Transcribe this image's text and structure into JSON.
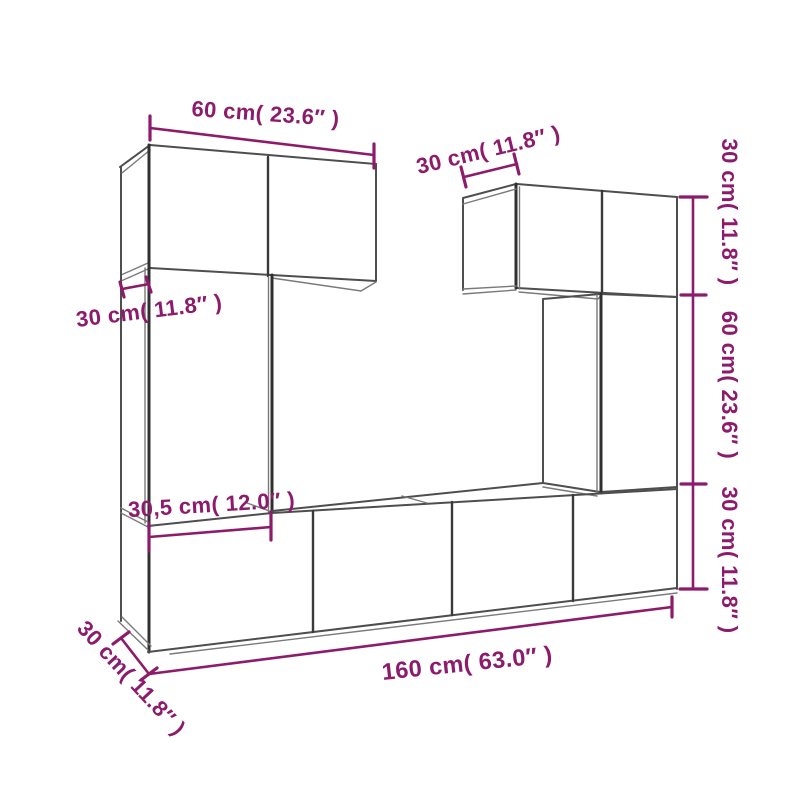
{
  "diagram": {
    "background": "#ffffff",
    "outline_color": "#4E4E4E",
    "accent_color": "#8C1B6C",
    "dimension_labels": {
      "top_width": "60 cm( 23.6″ )",
      "left_depth": "30 cm( 11.8″ )",
      "upper_right_depth": "30 cm( 11.8″ )",
      "right_top_height": "30 cm( 11.8″ )",
      "right_middle_height": "60 cm( 23.6″ )",
      "right_bottom_height": "30 cm( 11.8″ )",
      "lower_left_width": "30,5 cm( 12.0″ )",
      "total_width": "160 cm( 63.0″ )",
      "bottom_depth": "30 cm( 11.8″ )"
    }
  }
}
